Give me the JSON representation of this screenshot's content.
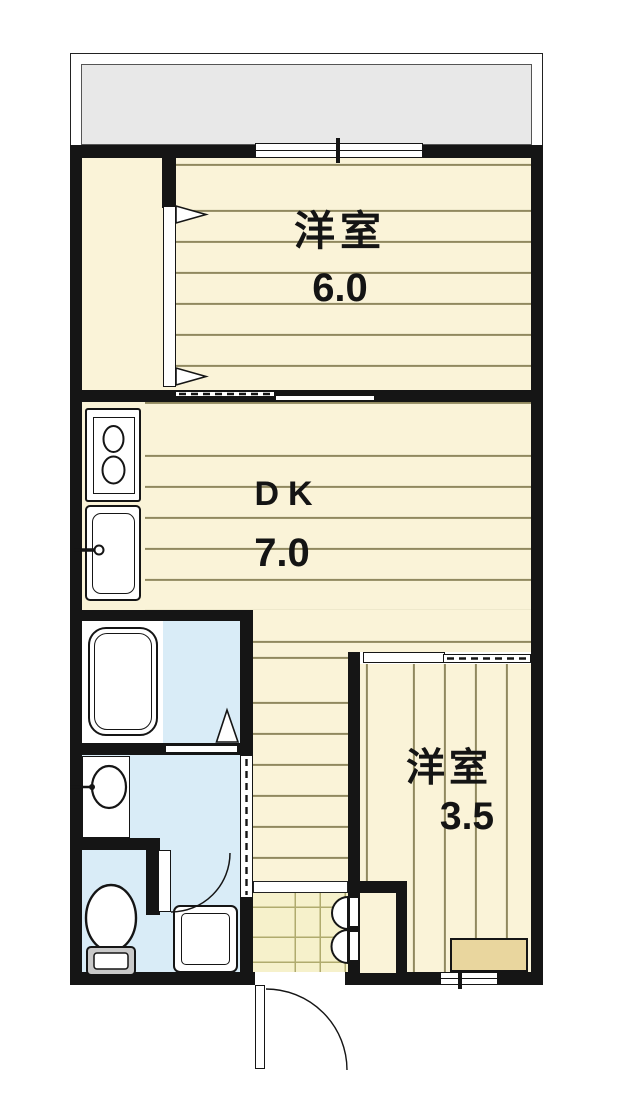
{
  "document": {
    "type": "floor-plan",
    "layout": "1DK apartment"
  },
  "rooms": [
    {
      "id": "western-room-6",
      "name": "洋室",
      "size": "6.0"
    },
    {
      "id": "dining-kitchen",
      "name": "DK",
      "size": "7.0"
    },
    {
      "id": "western-room-3-5",
      "name": "洋室",
      "size": "3.5"
    }
  ],
  "fixtures": [
    "balcony",
    "sliding-window",
    "closet",
    "closet-door-triangles",
    "gas-stove",
    "kitchen-sink",
    "bathtub",
    "bathroom-door-triangle",
    "washbasin",
    "toilet",
    "washing-machine-pan",
    "sliding-doors",
    "entrance-tile",
    "entrance-step",
    "shoe-cabinet",
    "entrance-door",
    "window-counter",
    "bottom-window"
  ],
  "colors": {
    "wall": "#151515",
    "flooring": "#faf3d8",
    "flooring_line": "#90885f",
    "wet_area": "#d9ecf7",
    "balcony_floor": "#e8e8e8",
    "entrance_tile": "#f6f1cb",
    "counter_top": "#e9d69e"
  }
}
